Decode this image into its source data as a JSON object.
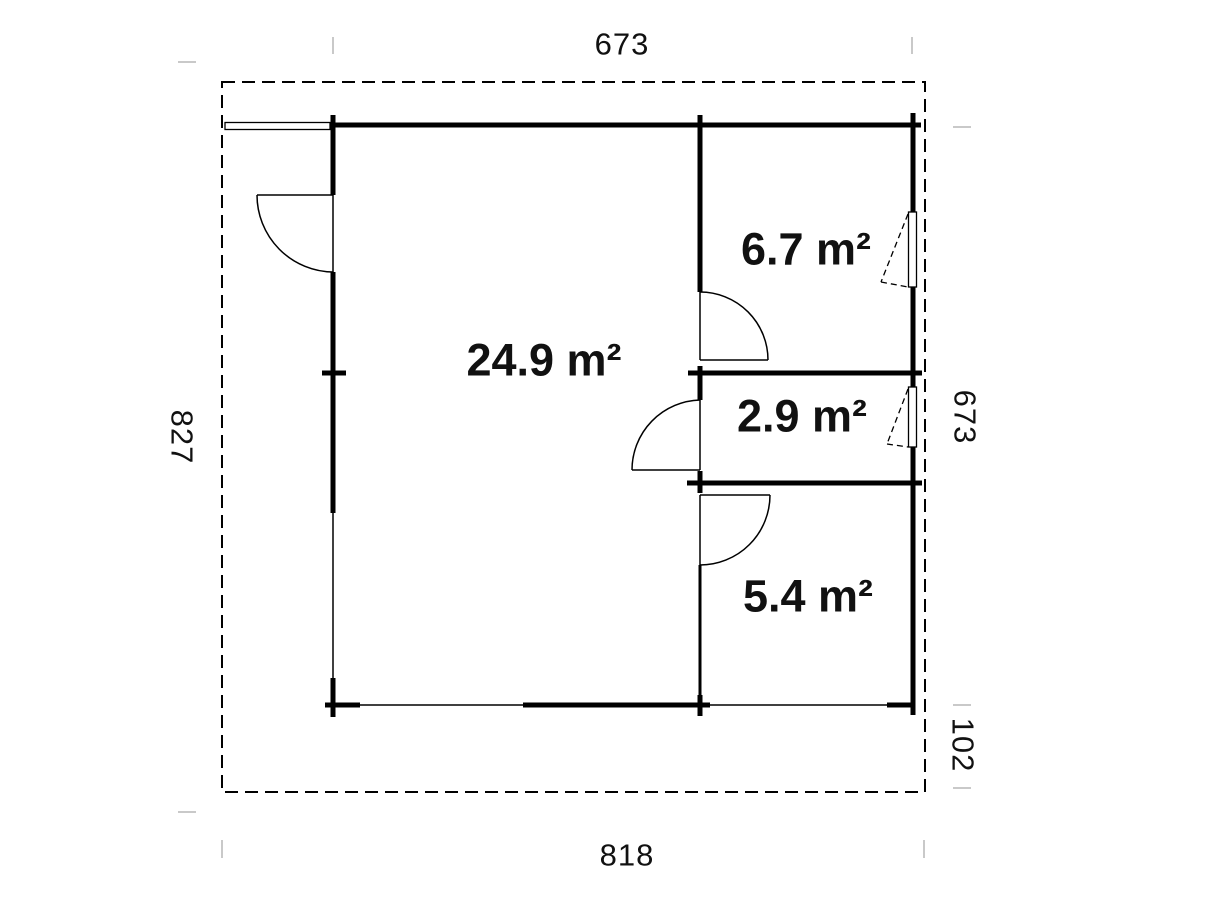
{
  "plan": {
    "title": "floor-plan",
    "rooms": [
      {
        "id": "main-room",
        "area_label": "24.9 m²"
      },
      {
        "id": "room-top-right",
        "area_label": "6.7 m²"
      },
      {
        "id": "room-mid-right",
        "area_label": "2.9 m²"
      },
      {
        "id": "room-bottom-right",
        "area_label": "5.4 m²"
      }
    ],
    "dimensions": {
      "top": "673",
      "bottom": "818",
      "left": "827",
      "right_upper": "673",
      "right_lower": "102"
    },
    "colors": {
      "wall": "#000000",
      "dimension_tick": "#c9c9c9",
      "text": "#111111",
      "background": "#ffffff"
    }
  }
}
